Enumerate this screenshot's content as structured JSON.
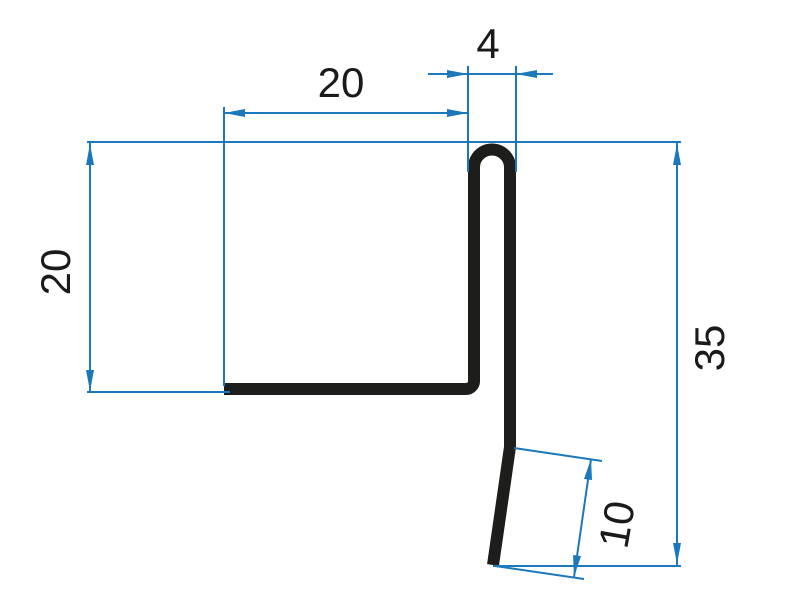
{
  "dimensions": {
    "top_flange": {
      "label": "20",
      "value": 20
    },
    "hem": {
      "label": "4",
      "value": 4
    },
    "inner_height": {
      "label": "20",
      "value": 20
    },
    "overall_height": {
      "label": "35",
      "value": 35
    },
    "drip_kick": {
      "label": "10",
      "value": 10
    }
  },
  "colors": {
    "dimension": "#1b78bb",
    "profile": "#1d1d1b",
    "text": "#1a1a1a",
    "background": "#ffffff"
  }
}
